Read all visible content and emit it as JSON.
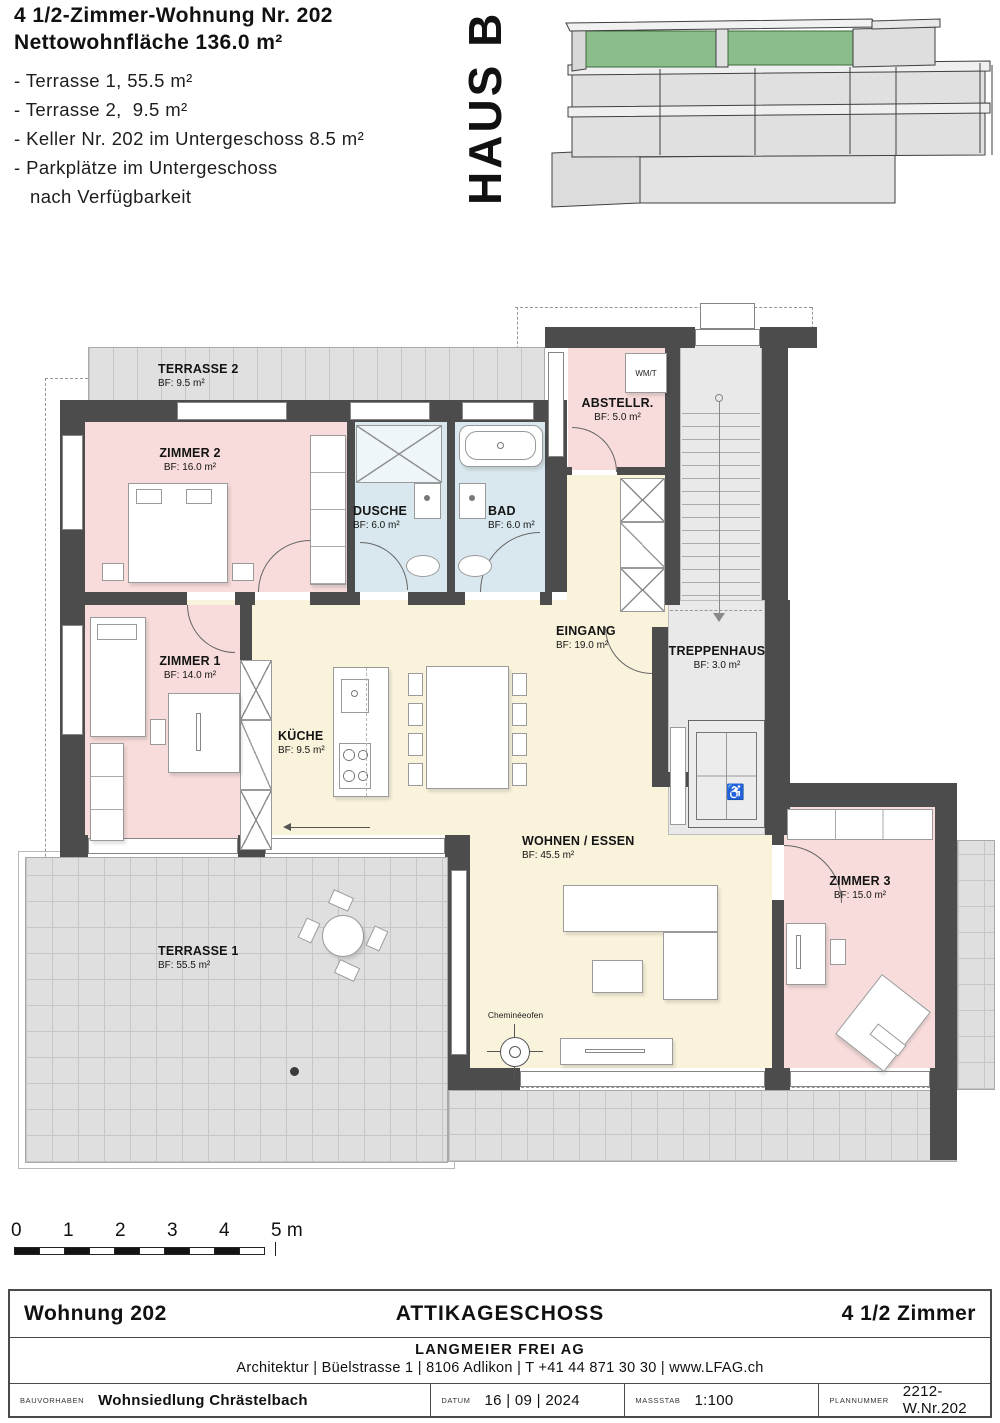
{
  "header": {
    "title_line1": "4 1/2-Zimmer-Wohnung Nr. 202",
    "title_line2": "Nettowohnfläche 136.0 m²",
    "bullets": [
      "- Terrasse 1, 55.5 m²",
      "- Terrasse 2,  9.5 m²",
      "- Keller Nr. 202 im Untergeschoss 8.5 m²",
      "- Parkplätze im Untergeschoss",
      "nach Verfügbarkeit"
    ],
    "haus_label": "HAUS B"
  },
  "plan": {
    "rooms": {
      "terrasse2": {
        "name": "TERRASSE 2",
        "area": "BF: 9.5 m²"
      },
      "zimmer2": {
        "name": "ZIMMER 2",
        "area": "BF: 16.0 m²"
      },
      "dusche": {
        "name": "DUSCHE",
        "area": "BF: 6.0 m²"
      },
      "bad": {
        "name": "BAD",
        "area": "BF: 6.0 m²"
      },
      "abstellraum": {
        "name": "ABSTELLR.",
        "area": "BF: 5.0 m²"
      },
      "eingang": {
        "name": "EINGANG",
        "area": "BF: 19.0 m²"
      },
      "treppenhaus": {
        "name": "TREPPENHAUS",
        "area": "BF: 3.0 m²"
      },
      "zimmer1": {
        "name": "ZIMMER 1",
        "area": "BF: 14.0 m²"
      },
      "kueche": {
        "name": "KÜCHE",
        "area": "BF: 9.5 m²"
      },
      "wohnen": {
        "name": "WOHNEN / ESSEN",
        "area": "BF: 45.5 m²"
      },
      "zimmer3": {
        "name": "ZIMMER 3",
        "area": "BF: 15.0 m²"
      },
      "terrasse1": {
        "name": "TERRASSE 1",
        "area": "BF: 55.5 m²"
      }
    },
    "annotations": {
      "wmt": "WM/T",
      "cheminee": "Cheminéeofen"
    }
  },
  "scalebar": {
    "labels": [
      "0",
      "1",
      "2",
      "3",
      "4",
      "5 m"
    ]
  },
  "footer": {
    "apartment": "Wohnung 202",
    "floor": "ATTIKAGESCHOSS",
    "rooms": "4 1/2 Zimmer",
    "company": "LANGMEIER FREI AG",
    "address": "Architektur | Büelstrasse 1 | 8106 Adlikon | T +41 44 871 30 30 | www.LFAG.ch",
    "project_label": "BAUVORHABEN",
    "project": "Wohnsiedlung Chrästelbach",
    "date_label": "DATUM",
    "date": "16 | 09 | 2024",
    "scale_label": "MASSSTAB",
    "scale": "1:100",
    "plannr_label": "PLANNUMMER",
    "plannr": "2212-W.Nr.202"
  },
  "colors": {
    "wall": "#4c4c4c",
    "room_pink": "#f7dcdb",
    "room_blue": "#d9e8ee",
    "room_cream": "#faf3dc",
    "terrace_gray": "#dfdfdf",
    "attic_green": "#8abd8a"
  }
}
